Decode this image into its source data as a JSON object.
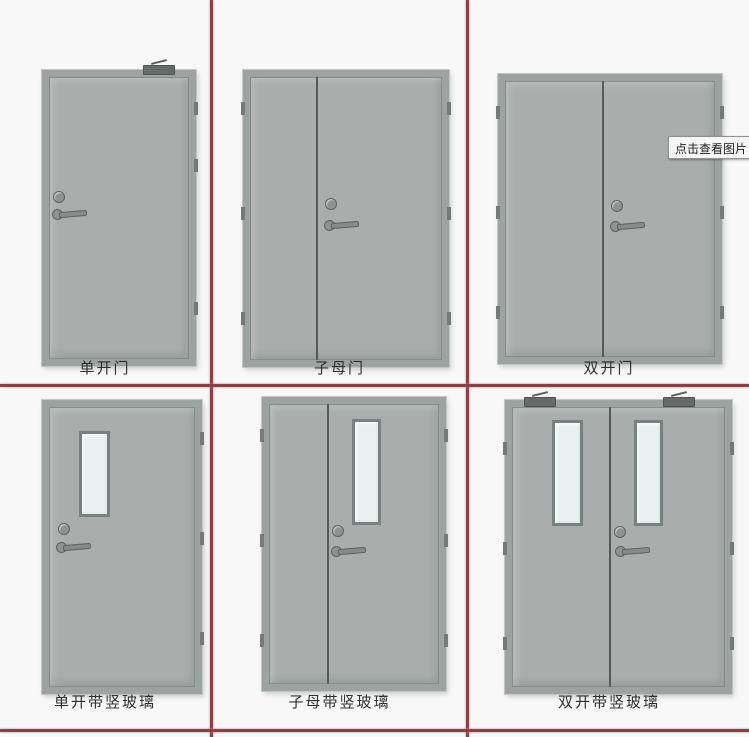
{
  "image": {
    "description_role": "fire-door type diagram, 2x3 grid separated by red lines"
  },
  "tooltip": {
    "text": "点击查看图片"
  },
  "doors": [
    {
      "label": "单开门",
      "type": "single-leaf"
    },
    {
      "label": "子母门",
      "type": "unequal-double-leaf"
    },
    {
      "label": "双开门",
      "type": "equal-double-leaf"
    },
    {
      "label": "单开带竖玻璃",
      "type": "single-leaf-vertical-glass"
    },
    {
      "label": "子母带竖玻璃",
      "type": "unequal-double-leaf-vertical-glass"
    },
    {
      "label": "双开带竖玻璃",
      "type": "equal-double-leaf-vertical-glass"
    }
  ],
  "colors": {
    "background": "#f7f8f7",
    "grid_line_red": "#8a4046",
    "door_fill": "#a9aeac",
    "door_frame": "#9da3a1",
    "glass_fill": "#e9f2f1",
    "glass_frame": "#798080",
    "hardware_gray": "#8e9391",
    "label_text": "#2e2e2e"
  }
}
